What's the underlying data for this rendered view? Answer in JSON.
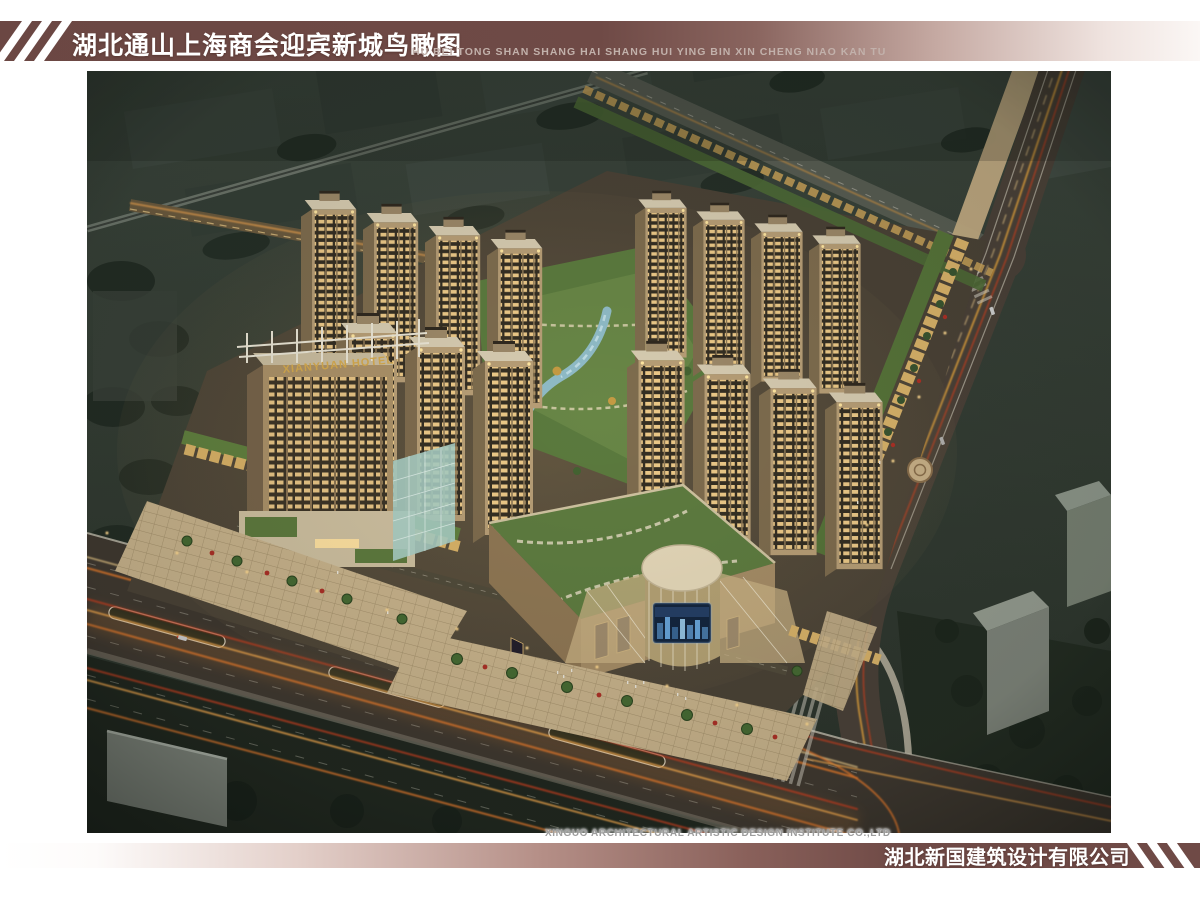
{
  "header": {
    "title_cn": "湖北通山上海商会迎宾新城鸟瞰图",
    "subtitle_pinyin": "HU BEI TONG SHAN SHANG HAI SHANG HUI YING BIN XIN CHENG NIAO KAN TU"
  },
  "footer": {
    "institute_en": "XINGUO ARCHITECTURAL ARTISTIC DESIGN INSTITUTE CO.,LTD",
    "company_cn": "湖北新国建筑设计有限公司"
  },
  "scene": {
    "hotel_sign_text": "XIANYUAN HOTEL"
  },
  "colors": {
    "band_maroon": "#6f4a46",
    "band_light": "#f3eae6",
    "pinyin_gray": "#c2b1ab",
    "institute_gray": "#9c9c9c",
    "trail_orange": "#e2782c",
    "trail_red": "#c23f22",
    "trail_yellow": "#f4a94e",
    "lit_window": "#f1cd8a"
  }
}
